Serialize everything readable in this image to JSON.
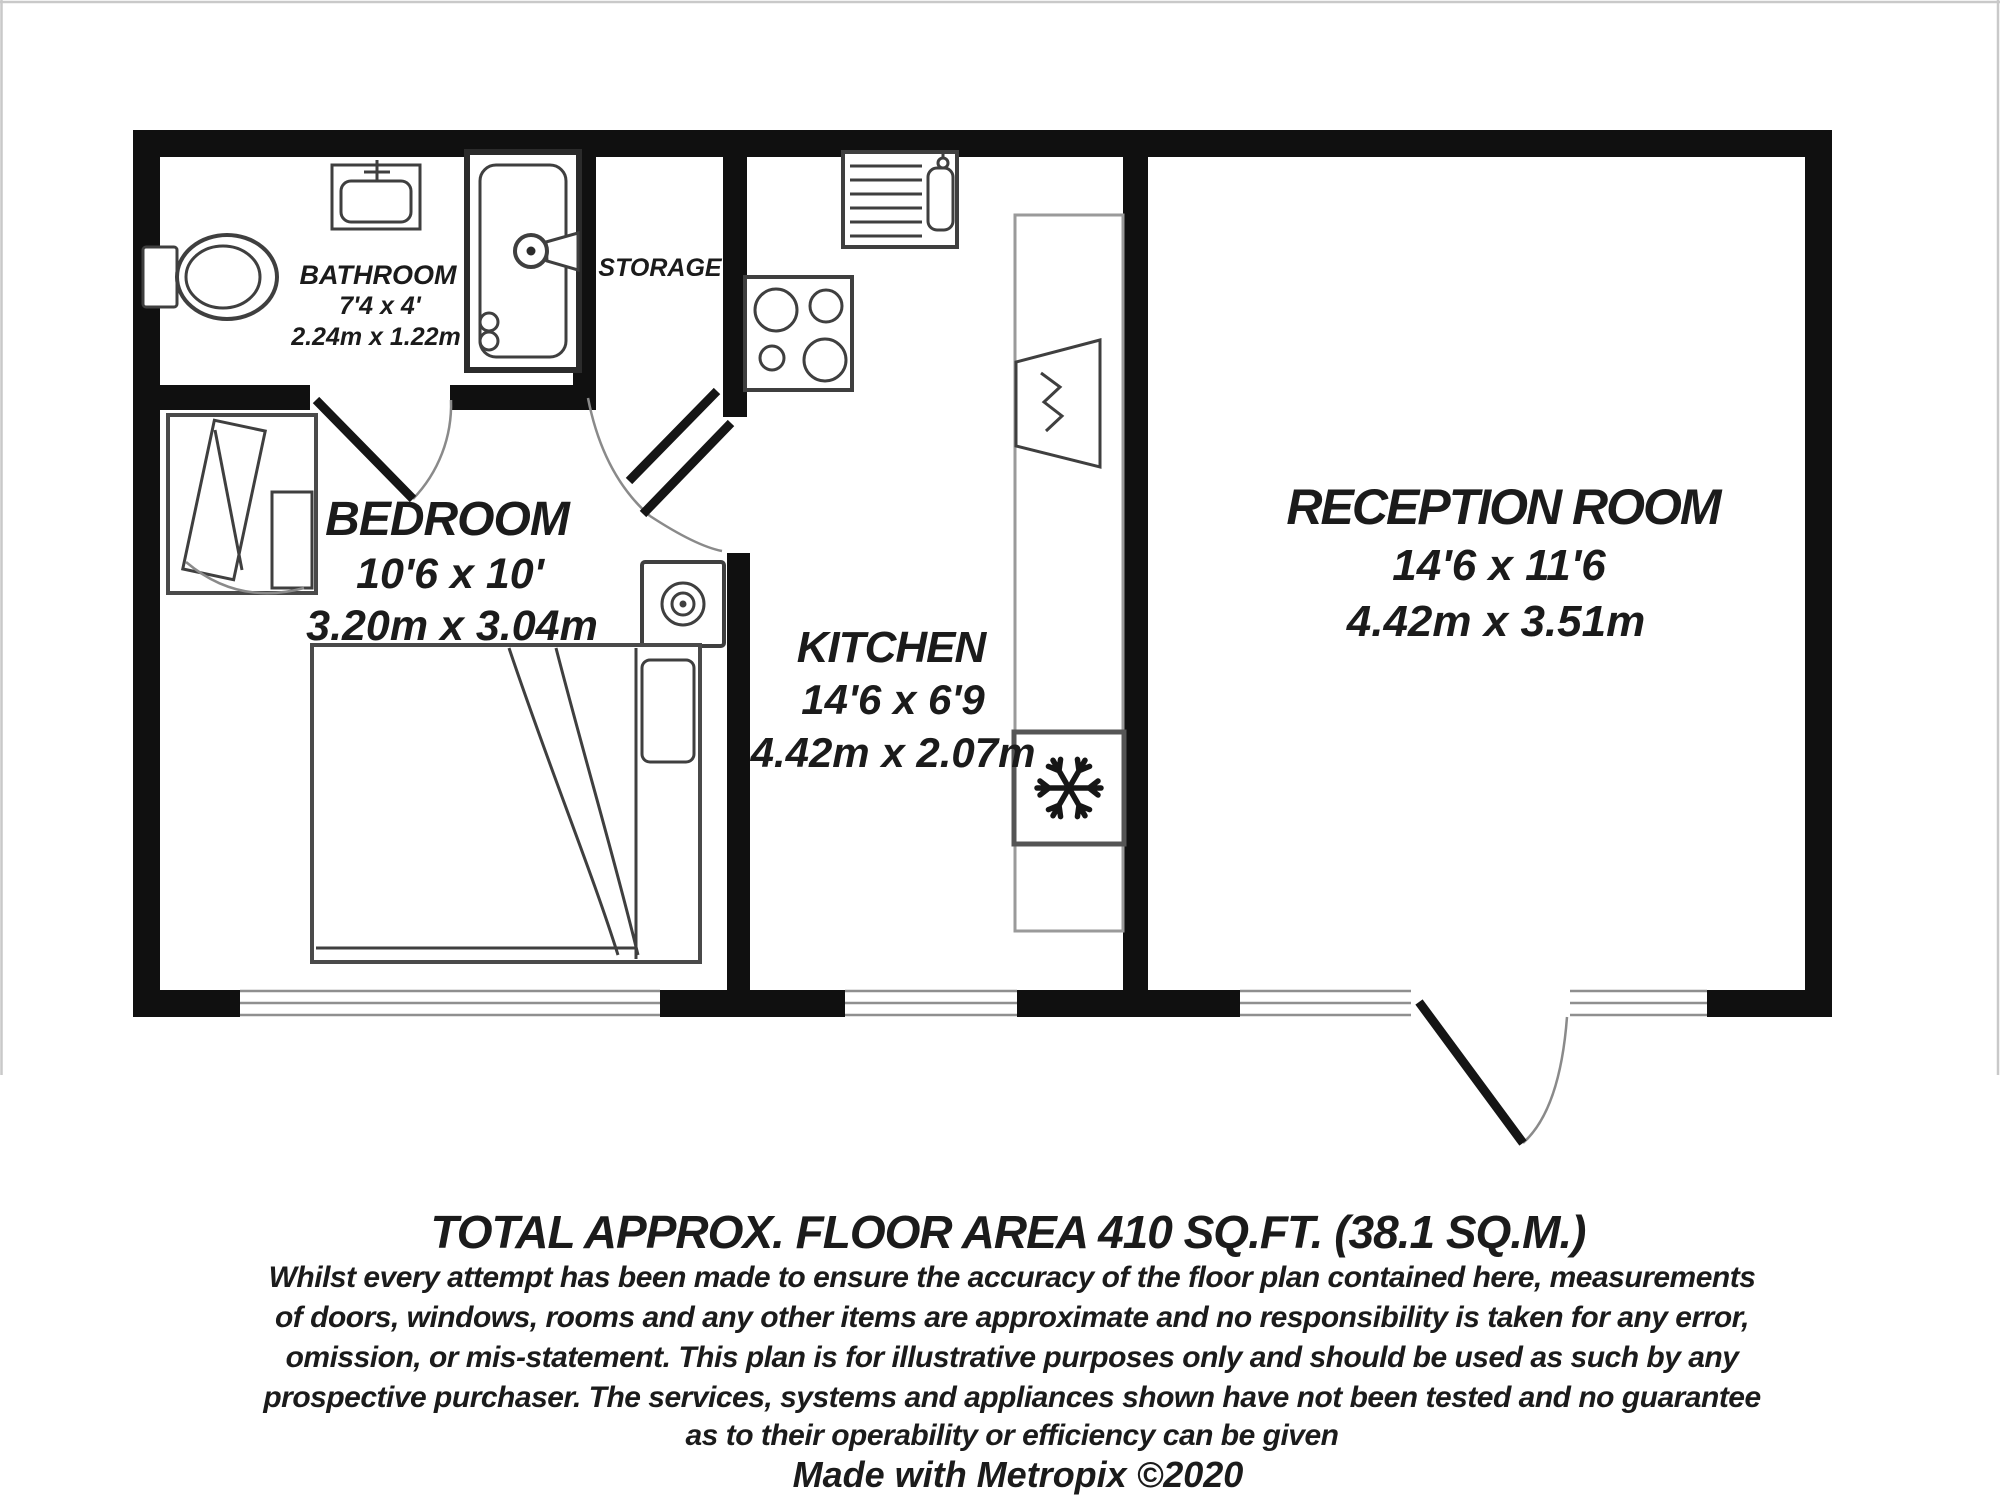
{
  "rooms": {
    "bathroom": {
      "name": "BATHROOM",
      "dims_imperial": "7'4 x 4'",
      "dims_metric": "2.24m x 1.22m"
    },
    "storage": {
      "name": "STORAGE"
    },
    "bedroom": {
      "name": "BEDROOM",
      "dims_imperial": "10'6 x 10'",
      "dims_metric": "3.20m x 3.04m"
    },
    "kitchen": {
      "name": "KITCHEN",
      "dims_imperial": "14'6 x 6'9",
      "dims_metric": "4.42m x 2.07m"
    },
    "reception": {
      "name": "RECEPTION ROOM",
      "dims_imperial": "14'6 x 11'6",
      "dims_metric": "4.42m x 3.51m"
    }
  },
  "icons": {
    "freezer": "snowflake-icon",
    "bathroom": [
      "toilet-icon",
      "sink-icon",
      "shower-icon"
    ],
    "kitchen": [
      "kitchen-sink-icon",
      "hob-icon",
      "washing-machine-icon"
    ],
    "bedroom": [
      "bed-icon",
      "wardrobe-icon"
    ]
  },
  "footer": {
    "total_area": "TOTAL APPROX. FLOOR AREA 410 SQ.FT. (38.1 SQ.M.)",
    "disclaimer_lines": [
      "Whilst every attempt has been made to ensure the accuracy of the floor plan contained here, measurements",
      "of doors, windows, rooms and any other items are approximate and no responsibility is taken for any error,",
      "omission, or mis-statement. This plan is for illustrative purposes only and should be used as such by any",
      "prospective purchaser. The services, systems and appliances shown have not been tested and no guarantee",
      "as to their operability or efficiency can be given"
    ],
    "credit": "Made with Metropix ©2020"
  },
  "colors": {
    "wall": "#101010",
    "fixture_line": "#3f3f3f",
    "light_line": "#8f8f8f",
    "text": "#1b1b1b",
    "background": "#ffffff"
  }
}
